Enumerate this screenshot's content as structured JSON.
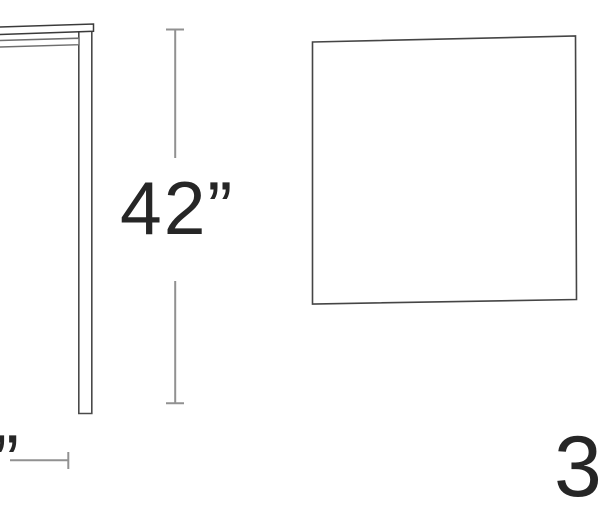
{
  "diagram": {
    "labels": {
      "height_dimension": "42”",
      "width_dimension_partial_quote": "”",
      "depth_dimension_partial": "3"
    },
    "colors": {
      "background": "#ffffff",
      "dimension_line": "#919191",
      "tabletop_line": "#3a3a3a",
      "apron_line": "#6e6e6e",
      "leg_line": "#4a4a4a",
      "panel_line": "#454545",
      "label_text": "#262626"
    }
  }
}
